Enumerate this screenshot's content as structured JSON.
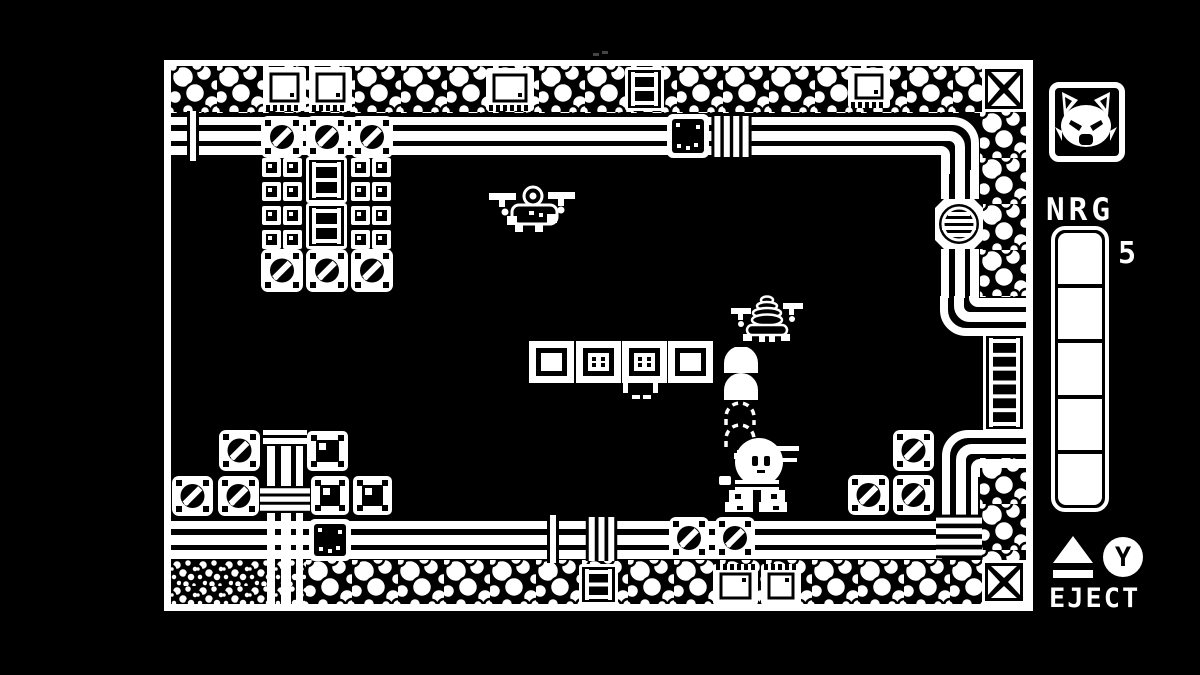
{
  "meta": {
    "background": "#000000",
    "foreground": "#ffffff",
    "accent": "#ffffff"
  },
  "hud": {
    "avatar_icon": "cat-face-icon",
    "energy": {
      "label": "NRG",
      "value": "5",
      "segments_total": 5,
      "segments_filled": 5
    },
    "eject": {
      "label": "EJECT",
      "button": "Y",
      "eject_icon": "eject-symbol-icon",
      "button_icon": "y-button-icon"
    }
  },
  "scene": {
    "viewport": {
      "x": 164,
      "y": 60,
      "width": 869,
      "height": 551
    },
    "sprites": [
      {
        "t": "bubbles-h",
        "n": "border-bubbles-top",
        "x": 171,
        "y": 66,
        "w": 855,
        "h": 47
      },
      {
        "t": "bubbles-v",
        "n": "border-bubbles-right-upper",
        "x": 980,
        "y": 112,
        "w": 46,
        "h": 185
      },
      {
        "t": "bubbles-v",
        "n": "border-bubbles-right-lower",
        "x": 980,
        "y": 458,
        "w": 46,
        "h": 104
      },
      {
        "t": "pebbles",
        "n": "border-pebbles-bottom-left",
        "x": 171,
        "y": 560,
        "w": 135,
        "h": 45
      },
      {
        "t": "bubbles-h",
        "n": "border-bubbles-bottom",
        "x": 306,
        "y": 560,
        "w": 678,
        "h": 45
      },
      {
        "t": "x-block",
        "n": "corner-block-top-right",
        "x": 982,
        "y": 66,
        "w": 44,
        "h": 46
      },
      {
        "t": "x-block",
        "n": "corner-block-bottom-right",
        "x": 982,
        "y": 560,
        "w": 44,
        "h": 44
      },
      {
        "t": "crate-teeth",
        "n": "machine-crate",
        "x": 263,
        "y": 67,
        "w": 43,
        "h": 44
      },
      {
        "t": "crate-teeth",
        "n": "machine-crate",
        "x": 309,
        "y": 67,
        "w": 43,
        "h": 44
      },
      {
        "t": "crate-teeth",
        "n": "machine-crate",
        "x": 486,
        "y": 68,
        "w": 48,
        "h": 43
      },
      {
        "t": "crate-teeth",
        "n": "machine-crate",
        "x": 848,
        "y": 68,
        "w": 42,
        "h": 40
      },
      {
        "t": "ladder-tile",
        "n": "ladder-tile-top",
        "x": 625,
        "y": 67,
        "w": 39,
        "h": 44
      },
      {
        "t": "ladder-tile",
        "n": "ladder-tile-bottom",
        "x": 579,
        "y": 564,
        "w": 39,
        "h": 41
      },
      {
        "t": "crate-teeth",
        "n": "machine-crate",
        "x": 713,
        "y": 564,
        "w": 45,
        "h": 41,
        "f": "y"
      },
      {
        "t": "crate-teeth",
        "n": "machine-crate",
        "x": 761,
        "y": 564,
        "w": 40,
        "h": 41,
        "f": "y"
      },
      {
        "t": "pipe-h",
        "n": "pipe-top",
        "x": 171,
        "y": 117,
        "w": 757,
        "h": 38
      },
      {
        "t": "pipe-bend",
        "n": "pipe-bend-top-right",
        "x": 926,
        "y": 117,
        "w": 53,
        "h": 57
      },
      {
        "t": "pipe-v",
        "n": "pipe-right-upper",
        "x": 941,
        "y": 170,
        "w": 38,
        "h": 32
      },
      {
        "t": "pipe-v",
        "n": "pipe-right-mid",
        "x": 941,
        "y": 246,
        "w": 38,
        "h": 52
      },
      {
        "t": "pipe-bend",
        "n": "pipe-bend-to-right-wall",
        "x": 940,
        "y": 296,
        "w": 88,
        "h": 40,
        "f": "xy"
      },
      {
        "t": "ladder-tile",
        "n": "wall-ladder-right",
        "x": 983,
        "y": 333,
        "w": 43,
        "h": 99
      },
      {
        "t": "pipe-bend",
        "n": "pipe-bend-from-right-wall",
        "x": 942,
        "y": 430,
        "w": 86,
        "h": 47,
        "f": "x"
      },
      {
        "t": "pipe-v",
        "n": "pipe-right-lower",
        "x": 942,
        "y": 476,
        "w": 36,
        "h": 82
      },
      {
        "t": "pipe-h",
        "n": "pipe-bottom",
        "x": 171,
        "y": 521,
        "w": 771,
        "h": 38
      },
      {
        "t": "pipe-v",
        "n": "pipe-left-column",
        "x": 267,
        "y": 428,
        "w": 36,
        "h": 177
      },
      {
        "t": "hatch",
        "n": "round-hatch-door",
        "x": 935,
        "y": 199,
        "w": 48,
        "h": 50
      },
      {
        "t": "clamp-v",
        "n": "pipe-clamp",
        "x": 185,
        "y": 111,
        "w": 16,
        "h": 50,
        "b": 1
      },
      {
        "t": "crate-dark",
        "n": "dark-crate",
        "x": 667,
        "y": 114,
        "w": 42,
        "h": 44
      },
      {
        "t": "clamp-v",
        "n": "pipe-clamp",
        "x": 711,
        "y": 116,
        "w": 41,
        "h": 41,
        "b": 4
      },
      {
        "t": "clamp-v",
        "n": "pipe-clamp",
        "x": 544,
        "y": 515,
        "w": 18,
        "h": 48,
        "b": 1
      },
      {
        "t": "clamp-v",
        "n": "pipe-clamp",
        "x": 585,
        "y": 517,
        "w": 33,
        "h": 44,
        "b": 3
      },
      {
        "t": "crate-screw",
        "n": "screw-crate",
        "x": 669,
        "y": 517,
        "w": 40,
        "h": 42
      },
      {
        "t": "crate-screw",
        "n": "screw-crate",
        "x": 715,
        "y": 517,
        "w": 40,
        "h": 42
      },
      {
        "t": "clamp-h",
        "n": "pipe-junction-clamp",
        "x": 936,
        "y": 513,
        "w": 46,
        "h": 47,
        "b": 4
      },
      {
        "t": "clamp-h",
        "n": "pipe-clamp",
        "x": 263,
        "y": 428,
        "w": 44,
        "h": 18,
        "b": 2
      },
      {
        "t": "clamp-h",
        "n": "pipe-clamp",
        "x": 260,
        "y": 486,
        "w": 50,
        "h": 27,
        "b": 3
      },
      {
        "t": "crate-dark",
        "n": "dark-crate",
        "x": 309,
        "y": 519,
        "w": 42,
        "h": 42
      },
      {
        "t": "crate-screw",
        "n": "screw-crate",
        "x": 261,
        "y": 116,
        "w": 42,
        "h": 42
      },
      {
        "t": "crate-screw",
        "n": "screw-crate",
        "x": 306,
        "y": 116,
        "w": 42,
        "h": 42
      },
      {
        "t": "crate-screw",
        "n": "screw-crate",
        "x": 351,
        "y": 116,
        "w": 42,
        "h": 42
      },
      {
        "t": "vent-grid",
        "n": "vent-tile-grid",
        "x": 262,
        "y": 158,
        "w": 41,
        "h": 91
      },
      {
        "t": "vent-grid",
        "n": "vent-tile-grid",
        "x": 351,
        "y": 158,
        "w": 41,
        "h": 91
      },
      {
        "t": "ladder-tile",
        "n": "ladder-tile-mid",
        "x": 306,
        "y": 157,
        "w": 41,
        "h": 46
      },
      {
        "t": "ladder-tile",
        "n": "ladder-tile-mid",
        "x": 306,
        "y": 203,
        "w": 41,
        "h": 46
      },
      {
        "t": "crate-screw",
        "n": "screw-crate",
        "x": 261,
        "y": 249,
        "w": 42,
        "h": 43
      },
      {
        "t": "crate-screw",
        "n": "screw-crate",
        "x": 306,
        "y": 249,
        "w": 42,
        "h": 43
      },
      {
        "t": "crate-screw",
        "n": "screw-crate",
        "x": 351,
        "y": 249,
        "w": 42,
        "h": 43
      },
      {
        "t": "crate-screw",
        "n": "screw-crate",
        "x": 219,
        "y": 430,
        "w": 41,
        "h": 41
      },
      {
        "t": "crate-screw",
        "n": "screw-crate",
        "x": 172,
        "y": 476,
        "w": 41,
        "h": 40
      },
      {
        "t": "crate-screw",
        "n": "screw-crate",
        "x": 218,
        "y": 476,
        "w": 41,
        "h": 40
      },
      {
        "t": "crate-dot",
        "n": "dot-crate",
        "x": 307,
        "y": 431,
        "w": 41,
        "h": 40
      },
      {
        "t": "crate-dot",
        "n": "dot-crate",
        "x": 311,
        "y": 476,
        "w": 38,
        "h": 39
      },
      {
        "t": "crate-dot",
        "n": "dot-crate",
        "x": 353,
        "y": 476,
        "w": 39,
        "h": 39
      },
      {
        "t": "crate-screw",
        "n": "screw-crate",
        "x": 893,
        "y": 430,
        "w": 41,
        "h": 41
      },
      {
        "t": "crate-screw",
        "n": "screw-crate",
        "x": 848,
        "y": 475,
        "w": 41,
        "h": 40
      },
      {
        "t": "crate-screw",
        "n": "screw-crate",
        "x": 893,
        "y": 475,
        "w": 41,
        "h": 40
      },
      {
        "t": "block",
        "n": "block-plain",
        "x": 529,
        "y": 341,
        "w": 45,
        "h": 42,
        "v": "plain"
      },
      {
        "t": "block",
        "n": "block-dotted",
        "x": 576,
        "y": 341,
        "w": 45,
        "h": 42,
        "v": "dots"
      },
      {
        "t": "block",
        "n": "block-dotted",
        "x": 622,
        "y": 341,
        "w": 45,
        "h": 42,
        "v": "dots"
      },
      {
        "t": "block",
        "n": "block-plain",
        "x": 668,
        "y": 341,
        "w": 45,
        "h": 42,
        "v": "plain"
      },
      {
        "t": "debris",
        "n": "block-debris",
        "x": 623,
        "y": 383,
        "w": 35,
        "h": 16
      },
      {
        "t": "drone-a",
        "n": "enemy-drone",
        "x": 489,
        "y": 179,
        "w": 93,
        "h": 56
      },
      {
        "t": "drone-b",
        "n": "enemy-drone",
        "x": 719,
        "y": 292,
        "w": 85,
        "h": 50
      },
      {
        "t": "trail",
        "n": "jet-exhaust-trail",
        "x": 721,
        "y": 347,
        "w": 40,
        "h": 124
      },
      {
        "t": "mech",
        "n": "player-mech",
        "x": 715,
        "y": 428,
        "w": 85,
        "h": 86
      },
      {
        "t": "spark",
        "n": "dust-particle",
        "x": 593,
        "y": 51,
        "w": 16,
        "h": 6
      },
      {
        "t": "frame",
        "n": "playfield-frame-top",
        "x": 164,
        "y": 60,
        "w": 868,
        "h": 6
      },
      {
        "t": "frame",
        "n": "playfield-frame-left",
        "x": 164,
        "y": 60,
        "w": 7,
        "h": 551
      },
      {
        "t": "frame",
        "n": "playfield-frame-right",
        "x": 1026,
        "y": 60,
        "w": 7,
        "h": 551
      },
      {
        "t": "frame",
        "n": "playfield-frame-bottom",
        "x": 164,
        "y": 604,
        "w": 868,
        "h": 7
      }
    ]
  }
}
